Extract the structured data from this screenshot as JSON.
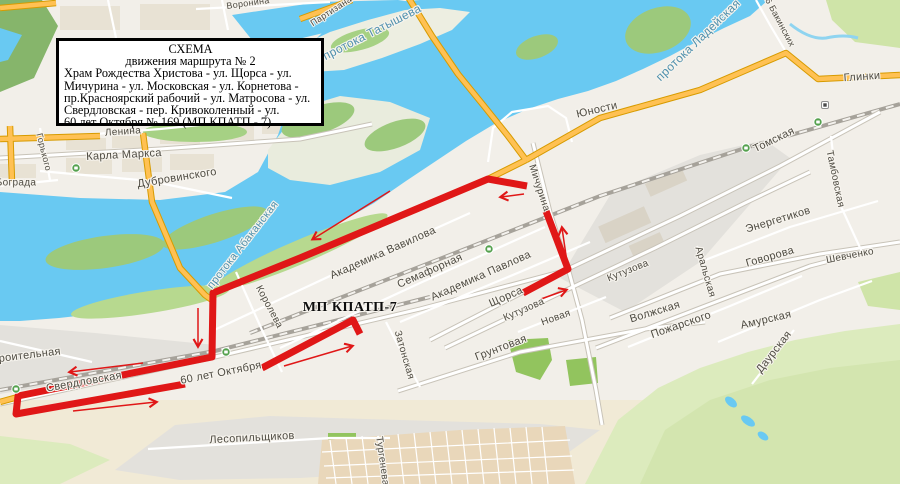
{
  "title_box": {
    "heading1": "СХЕМА",
    "heading2": "движения маршрута № 2",
    "body_lines": [
      "Храм Рождества Христова - ул. Щорса - ул.",
      "Мичурина - ул. Московская - ул. Корнетова -",
      "пр.Красноярский рабочий - ул. Матросова - ул.",
      "Свердловская - пер. Кривоколенный - ул.",
      "60 лет Октября № 169 (МП КПАТП - 7)."
    ]
  },
  "map": {
    "colors": {
      "route_red": "#e01717",
      "road_orange": "#ffc153",
      "road_orange_casing": "#d79b00",
      "water_blue": "#69c9f2",
      "rail_grey": "#a6a29a",
      "green_island": "#9cc97c",
      "hill_green": "#dcebbd",
      "bus_stop_green": "#55a14e"
    },
    "labels": [
      {
        "text": "Воронина",
        "x": 248,
        "y": 3,
        "rot": -8,
        "size": 9,
        "kind": "street"
      },
      {
        "text": "Партизана",
        "x": 331,
        "y": 11,
        "rot": -33,
        "size": 9,
        "kind": "street"
      },
      {
        "text": "протока Татышева",
        "x": 372,
        "y": 32,
        "rot": -27,
        "size": 12,
        "kind": "water"
      },
      {
        "text": "протока Ладейская",
        "x": 698,
        "y": 40,
        "rot": -44,
        "size": 12,
        "kind": "water"
      },
      {
        "text": "26 Бакинских",
        "x": 779,
        "y": 20,
        "rot": 62,
        "size": 9,
        "kind": "street"
      },
      {
        "text": "Глинки",
        "x": 862,
        "y": 77,
        "rot": -4,
        "size": 11,
        "kind": "street"
      },
      {
        "text": "Юности",
        "x": 597,
        "y": 110,
        "rot": -13,
        "size": 11,
        "kind": "street"
      },
      {
        "text": "Томская",
        "x": 774,
        "y": 140,
        "rot": -26,
        "size": 11,
        "kind": "street"
      },
      {
        "text": "Тамбовская",
        "x": 835,
        "y": 179,
        "rot": 78,
        "size": 10,
        "kind": "street"
      },
      {
        "text": "Энергетиков",
        "x": 778,
        "y": 220,
        "rot": -17,
        "size": 11,
        "kind": "street"
      },
      {
        "text": "Говорова",
        "x": 770,
        "y": 257,
        "rot": -16,
        "size": 11,
        "kind": "street"
      },
      {
        "text": "Шевченко",
        "x": 850,
        "y": 256,
        "rot": -11,
        "size": 10,
        "kind": "street"
      },
      {
        "text": "Аральская",
        "x": 705,
        "y": 272,
        "rot": 74,
        "size": 10,
        "kind": "street"
      },
      {
        "text": "Кутузова",
        "x": 628,
        "y": 271,
        "rot": -22,
        "size": 10,
        "kind": "street"
      },
      {
        "text": "Волжская",
        "x": 655,
        "y": 312,
        "rot": -17,
        "size": 11,
        "kind": "street"
      },
      {
        "text": "Пожарского",
        "x": 681,
        "y": 325,
        "rot": -19,
        "size": 11,
        "kind": "street"
      },
      {
        "text": "Амурская",
        "x": 766,
        "y": 320,
        "rot": -13,
        "size": 11,
        "kind": "street"
      },
      {
        "text": "Даурская",
        "x": 774,
        "y": 352,
        "rot": -52,
        "size": 11,
        "kind": "street"
      },
      {
        "text": "Карла Маркса",
        "x": 124,
        "y": 155,
        "rot": -3,
        "size": 11,
        "kind": "street"
      },
      {
        "text": "Ленина",
        "x": 123,
        "y": 132,
        "rot": -4,
        "size": 10,
        "kind": "street"
      },
      {
        "text": "Дубровинского",
        "x": 177,
        "y": 178,
        "rot": -9,
        "size": 11,
        "kind": "street"
      },
      {
        "text": "Бограда",
        "x": 16,
        "y": 183,
        "rot": 0,
        "size": 10,
        "kind": "street"
      },
      {
        "text": "Горького",
        "x": 44,
        "y": 152,
        "rot": 76,
        "size": 9,
        "kind": "street"
      },
      {
        "text": "протока Абаканская",
        "x": 243,
        "y": 245,
        "rot": -52,
        "size": 11,
        "kind": "water"
      },
      {
        "text": "Академика Вавилова",
        "x": 383,
        "y": 253,
        "rot": -24,
        "size": 11,
        "kind": "street"
      },
      {
        "text": "Семафорная",
        "x": 430,
        "y": 271,
        "rot": -24,
        "size": 11,
        "kind": "street"
      },
      {
        "text": "Академика Павлова",
        "x": 481,
        "y": 276,
        "rot": -24,
        "size": 11,
        "kind": "street"
      },
      {
        "text": "Щорса",
        "x": 506,
        "y": 297,
        "rot": -24,
        "size": 11,
        "kind": "street"
      },
      {
        "text": "Кутузова",
        "x": 524,
        "y": 310,
        "rot": -24,
        "size": 10,
        "kind": "street"
      },
      {
        "text": "Новая",
        "x": 556,
        "y": 318,
        "rot": -20,
        "size": 10,
        "kind": "street"
      },
      {
        "text": "Мичурина",
        "x": 539,
        "y": 188,
        "rot": 72,
        "size": 10,
        "kind": "street"
      },
      {
        "text": "Королева",
        "x": 269,
        "y": 307,
        "rot": 62,
        "size": 10,
        "kind": "street"
      },
      {
        "text": "МП КПАТП-7",
        "x": 350,
        "y": 308,
        "rot": 0,
        "size": 14,
        "kind": "poi"
      },
      {
        "text": "60 лет Октября",
        "x": 221,
        "y": 373,
        "rot": -11,
        "size": 11,
        "kind": "street"
      },
      {
        "text": "Свердловская",
        "x": 84,
        "y": 382,
        "rot": -10,
        "size": 11,
        "kind": "street"
      },
      {
        "text": "Строительная",
        "x": 23,
        "y": 356,
        "rot": -7,
        "size": 11,
        "kind": "street"
      },
      {
        "text": "Грунтовая",
        "x": 501,
        "y": 348,
        "rot": -21,
        "size": 11,
        "kind": "street"
      },
      {
        "text": "Затонская",
        "x": 404,
        "y": 355,
        "rot": 74,
        "size": 10,
        "kind": "street"
      },
      {
        "text": "Лесопильщиков",
        "x": 252,
        "y": 438,
        "rot": -3,
        "size": 11,
        "kind": "street"
      },
      {
        "text": "Тургенева",
        "x": 382,
        "y": 461,
        "rot": 82,
        "size": 10,
        "kind": "street"
      }
    ],
    "route": {
      "color": "#e01717",
      "width": 7,
      "paths": [
        [
          [
            527,
            186
          ],
          [
            488,
            179
          ],
          [
            300,
            258
          ],
          [
            213,
            293
          ],
          [
            212,
            357
          ],
          [
            18,
            396
          ],
          [
            16,
            414
          ],
          [
            185,
            384
          ]
        ],
        [
          [
            546,
            211
          ],
          [
            568,
            269
          ],
          [
            523,
            293
          ]
        ],
        [
          [
            262,
            368
          ],
          [
            353,
            320
          ],
          [
            360,
            334
          ]
        ]
      ],
      "arrows": [
        {
          "from": [
            524,
            194
          ],
          "to": [
            501,
            197
          ]
        },
        {
          "from": [
            390,
            191
          ],
          "to": [
            313,
            239
          ]
        },
        {
          "from": [
            567,
            262
          ],
          "to": [
            562,
            228
          ]
        },
        {
          "from": [
            541,
            299
          ],
          "to": [
            566,
            290
          ]
        },
        {
          "from": [
            198,
            308
          ],
          "to": [
            198,
            346
          ]
        },
        {
          "from": [
            143,
            363
          ],
          "to": [
            70,
            372
          ]
        },
        {
          "from": [
            73,
            411
          ],
          "to": [
            156,
            402
          ]
        },
        {
          "from": [
            284,
            366
          ],
          "to": [
            352,
            346
          ]
        }
      ]
    },
    "bus_stops": {
      "green": [
        [
          489,
          249
        ],
        [
          16,
          389
        ],
        [
          226,
          352
        ],
        [
          76,
          168
        ],
        [
          746,
          148
        ],
        [
          818,
          122
        ]
      ],
      "white": [
        [
          825,
          105
        ]
      ]
    }
  }
}
